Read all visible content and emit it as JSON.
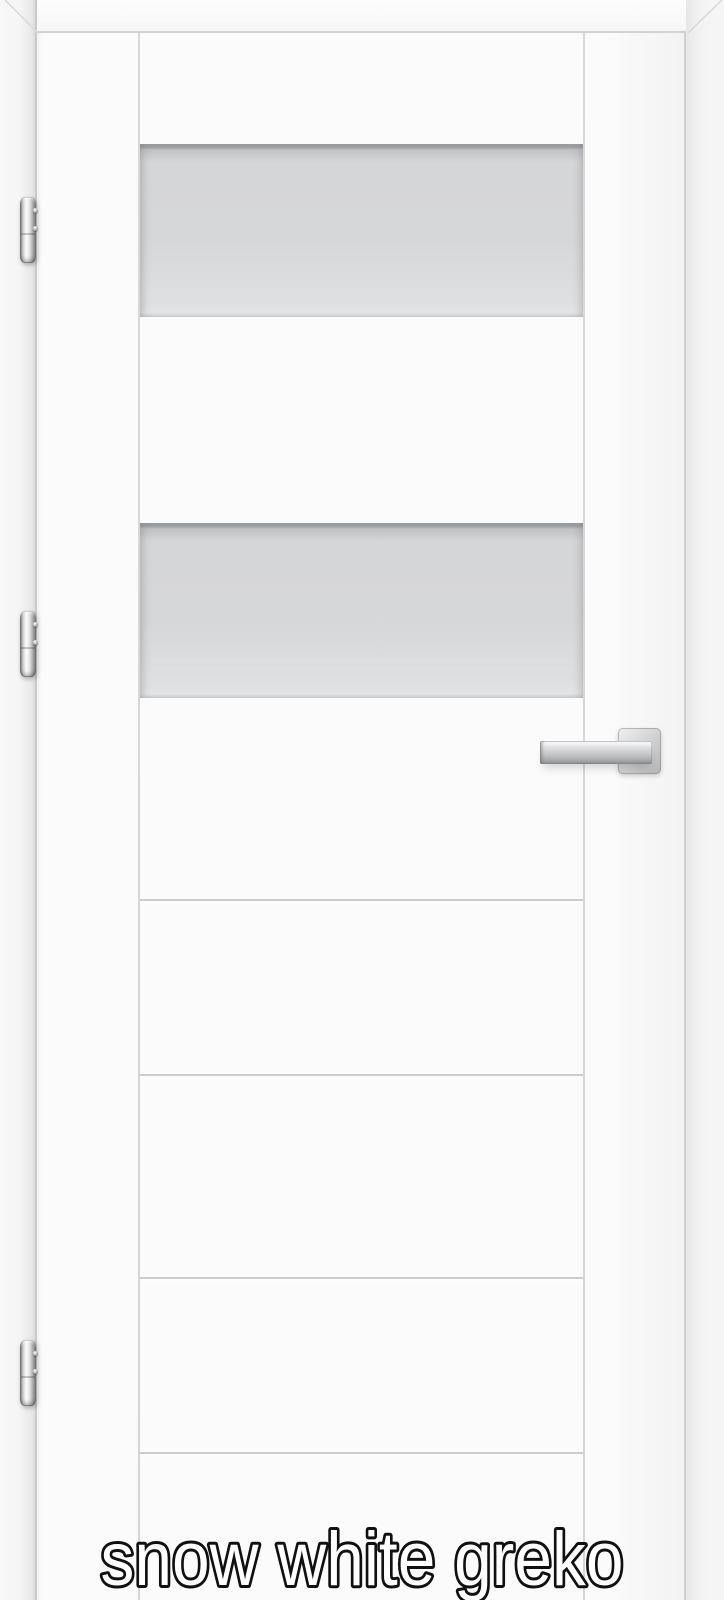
{
  "caption": {
    "text": "snow white greko"
  },
  "product": {
    "type": "interior-door-with-frame",
    "finish_color_name": "snow white",
    "model_name": "greko"
  },
  "door": {
    "leaf": {
      "left": 38,
      "top": 33,
      "width": 648,
      "height": 1567
    },
    "stile_grooves_x": [
      138,
      583
    ],
    "glass_panels": [
      {
        "top": 144,
        "height": 173
      },
      {
        "top": 523,
        "height": 175
      }
    ],
    "panel_grooves_y": [
      899,
      1074,
      1277,
      1452
    ]
  },
  "hardware": {
    "hinges": [
      {
        "left": 20,
        "top": 197,
        "width": 16,
        "height": 66
      },
      {
        "left": 20,
        "top": 611,
        "width": 16,
        "height": 66
      },
      {
        "left": 20,
        "top": 1340,
        "width": 16,
        "height": 66
      }
    ],
    "handle": {
      "rosette": {
        "left": 618,
        "top": 728,
        "width": 43,
        "height": 46
      },
      "lever": {
        "left": 540,
        "top": 741,
        "width": 112,
        "height": 23
      }
    }
  },
  "colors": {
    "background": "#f5f5f5",
    "door_white": "#fbfbfb",
    "glass_gray": "#d6d7d8",
    "groove_gray": "#cccccc",
    "metal_silver": "#c3c4c6",
    "caption_fill": "#ffffff",
    "caption_outline": "#101010"
  }
}
